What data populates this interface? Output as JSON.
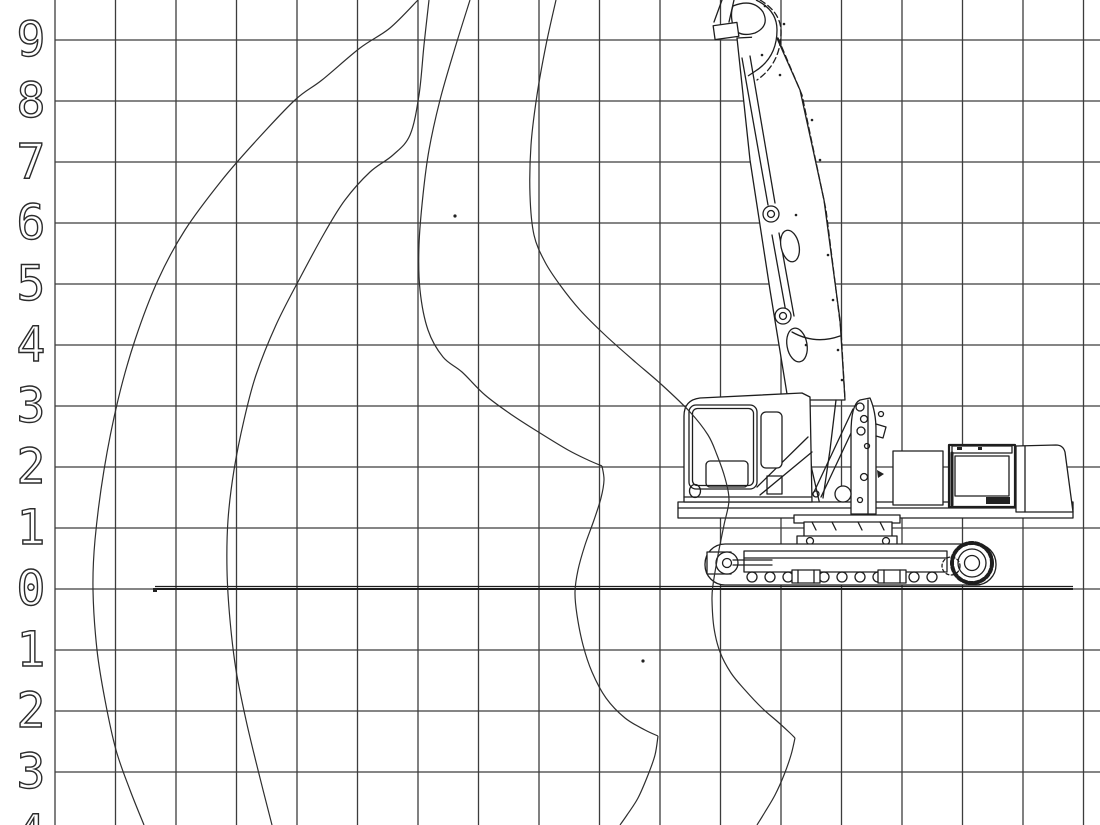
{
  "diagram": {
    "type": "working-range-diagram",
    "subject": "high-reach-demolition-excavator-side-view",
    "axis_unit": "m",
    "grid_step_m": 1,
    "background": "#ffffff",
    "line_color": "#2e2e2e"
  },
  "axis": {
    "labels": [
      {
        "text": "9",
        "y": 40
      },
      {
        "text": "8",
        "y": 101
      },
      {
        "text": "7",
        "y": 162
      },
      {
        "text": "6",
        "y": 223
      },
      {
        "text": "5",
        "y": 284
      },
      {
        "text": "4",
        "y": 345
      },
      {
        "text": "3",
        "y": 406
      },
      {
        "text": "2",
        "y": 467
      },
      {
        "text": "1",
        "y": 528
      },
      {
        "text": "0",
        "y": 589
      },
      {
        "text": "1",
        "y": 650
      },
      {
        "text": "2",
        "y": 711
      },
      {
        "text": "3",
        "y": 772
      },
      {
        "text": "4",
        "y": 833
      }
    ],
    "label_x": 31
  },
  "grid": {
    "x0": 55,
    "x_spacing": 60.5,
    "x_count": 18,
    "y_top": 0,
    "y_bottom": 825,
    "y0": 40,
    "y_spacing": 61,
    "y_count": 13,
    "x_left": 55,
    "x_right": 1100
  },
  "ground": {
    "y": 589,
    "x1": 155,
    "x2": 1073,
    "tick_x": 153
  },
  "curves": [
    {
      "name": "envelope-outer",
      "segments": [
        [
          [
            418,
            0
          ],
          [
            390,
            28
          ],
          [
            360,
            48
          ],
          [
            322,
            80
          ],
          [
            295,
            100
          ],
          [
            255,
            142
          ],
          [
            222,
            180
          ],
          [
            185,
            230
          ],
          [
            158,
            280
          ],
          [
            135,
            340
          ],
          [
            118,
            400
          ],
          [
            104,
            470
          ],
          [
            95,
            540
          ],
          [
            93,
            590
          ],
          [
            97,
            650
          ],
          [
            105,
            700
          ],
          [
            116,
            750
          ],
          [
            130,
            790
          ],
          [
            144,
            825
          ]
        ]
      ]
    },
    {
      "name": "envelope-middle",
      "segments": [
        [
          [
            429,
            0
          ],
          [
            424,
            45
          ],
          [
            419,
            95
          ],
          [
            410,
            135
          ],
          [
            393,
            155
          ],
          [
            370,
            172
          ],
          [
            345,
            200
          ],
          [
            325,
            232
          ],
          [
            300,
            278
          ],
          [
            276,
            325
          ],
          [
            256,
            375
          ],
          [
            244,
            420
          ],
          [
            234,
            470
          ],
          [
            228,
            520
          ],
          [
            227,
            570
          ],
          [
            230,
            620
          ],
          [
            236,
            670
          ],
          [
            246,
            720
          ],
          [
            258,
            770
          ],
          [
            272,
            825
          ]
        ]
      ]
    },
    {
      "name": "envelope-inner-and-dig-profile",
      "segments": [
        [
          [
            470,
            0
          ],
          [
            455,
            48
          ],
          [
            440,
            100
          ],
          [
            429,
            150
          ],
          [
            423,
            195
          ],
          [
            419,
            245
          ],
          [
            420,
            290
          ],
          [
            428,
            330
          ],
          [
            443,
            357
          ],
          [
            462,
            372
          ],
          [
            485,
            395
          ],
          [
            512,
            415
          ],
          [
            540,
            433
          ],
          [
            568,
            450
          ],
          [
            588,
            460
          ],
          [
            602,
            466
          ]
        ],
        [
          [
            602,
            466
          ],
          [
            604,
            480
          ],
          [
            601,
            498
          ],
          [
            594,
            520
          ],
          [
            585,
            545
          ],
          [
            578,
            570
          ],
          [
            575,
            592
          ],
          [
            577,
            615
          ],
          [
            583,
            645
          ],
          [
            592,
            672
          ],
          [
            606,
            698
          ],
          [
            625,
            718
          ],
          [
            645,
            730
          ],
          [
            658,
            736
          ]
        ],
        [
          [
            658,
            736
          ],
          [
            655,
            755
          ],
          [
            648,
            775
          ],
          [
            638,
            798
          ],
          [
            627,
            815
          ],
          [
            620,
            825
          ]
        ]
      ]
    },
    {
      "name": "envelope-near-machine",
      "segments": [
        [
          [
            556,
            0
          ],
          [
            546,
            45
          ],
          [
            537,
            95
          ],
          [
            531,
            145
          ],
          [
            530,
            195
          ],
          [
            534,
            235
          ],
          [
            545,
            262
          ],
          [
            560,
            285
          ],
          [
            580,
            310
          ],
          [
            605,
            335
          ],
          [
            633,
            360
          ],
          [
            662,
            385
          ],
          [
            690,
            412
          ],
          [
            708,
            435
          ],
          [
            717,
            455
          ],
          [
            725,
            478
          ],
          [
            729,
            500
          ],
          [
            724,
            525
          ],
          [
            718,
            555
          ],
          [
            713,
            585
          ],
          [
            712,
            600
          ],
          [
            714,
            628
          ],
          [
            720,
            652
          ],
          [
            731,
            673
          ],
          [
            745,
            690
          ],
          [
            762,
            708
          ],
          [
            778,
            722
          ],
          [
            790,
            733
          ],
          [
            795,
            738
          ]
        ],
        [
          [
            795,
            738
          ],
          [
            791,
            755
          ],
          [
            784,
            775
          ],
          [
            775,
            795
          ],
          [
            765,
            812
          ],
          [
            757,
            825
          ]
        ]
      ]
    }
  ],
  "marks": {
    "specks": [
      [
        455,
        216
      ],
      [
        643,
        661
      ]
    ]
  }
}
